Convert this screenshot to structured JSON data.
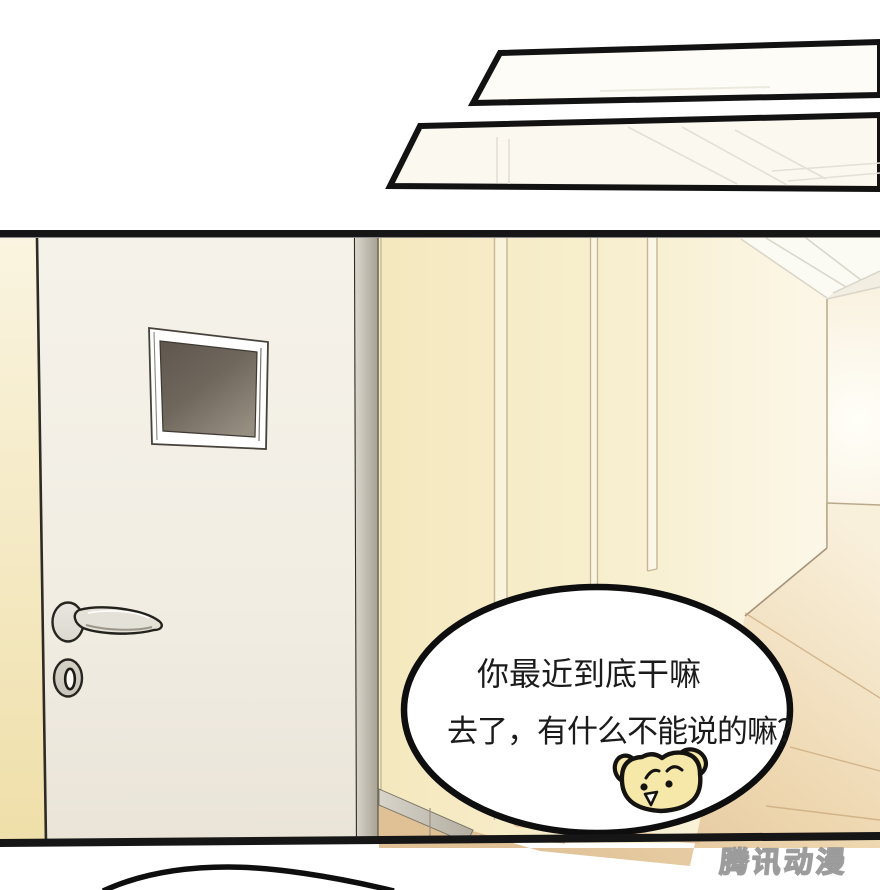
{
  "speech_bubble": {
    "line1": "你最近到底干嘛",
    "line2": "去了，有什么不能说的嘛？"
  },
  "watermark": {
    "text": "腾讯动漫"
  },
  "icons": {
    "speaker": "dog-face-icon"
  },
  "colors": {
    "panel_border": "#121212",
    "wall_yellow": "#f4e8bd",
    "door_cream": "#f1ede3",
    "door_jamb_gray": "#aaa295",
    "window_glass_dark": "#5f574e",
    "floor_tan": "#e9cfa6",
    "bubble_fill": "#ffffff",
    "bubble_stroke": "#0e0e0e",
    "dog_fill": "#f6e8a9",
    "dog_outline": "#151310",
    "watermark_gray": "#8f8f8f"
  }
}
